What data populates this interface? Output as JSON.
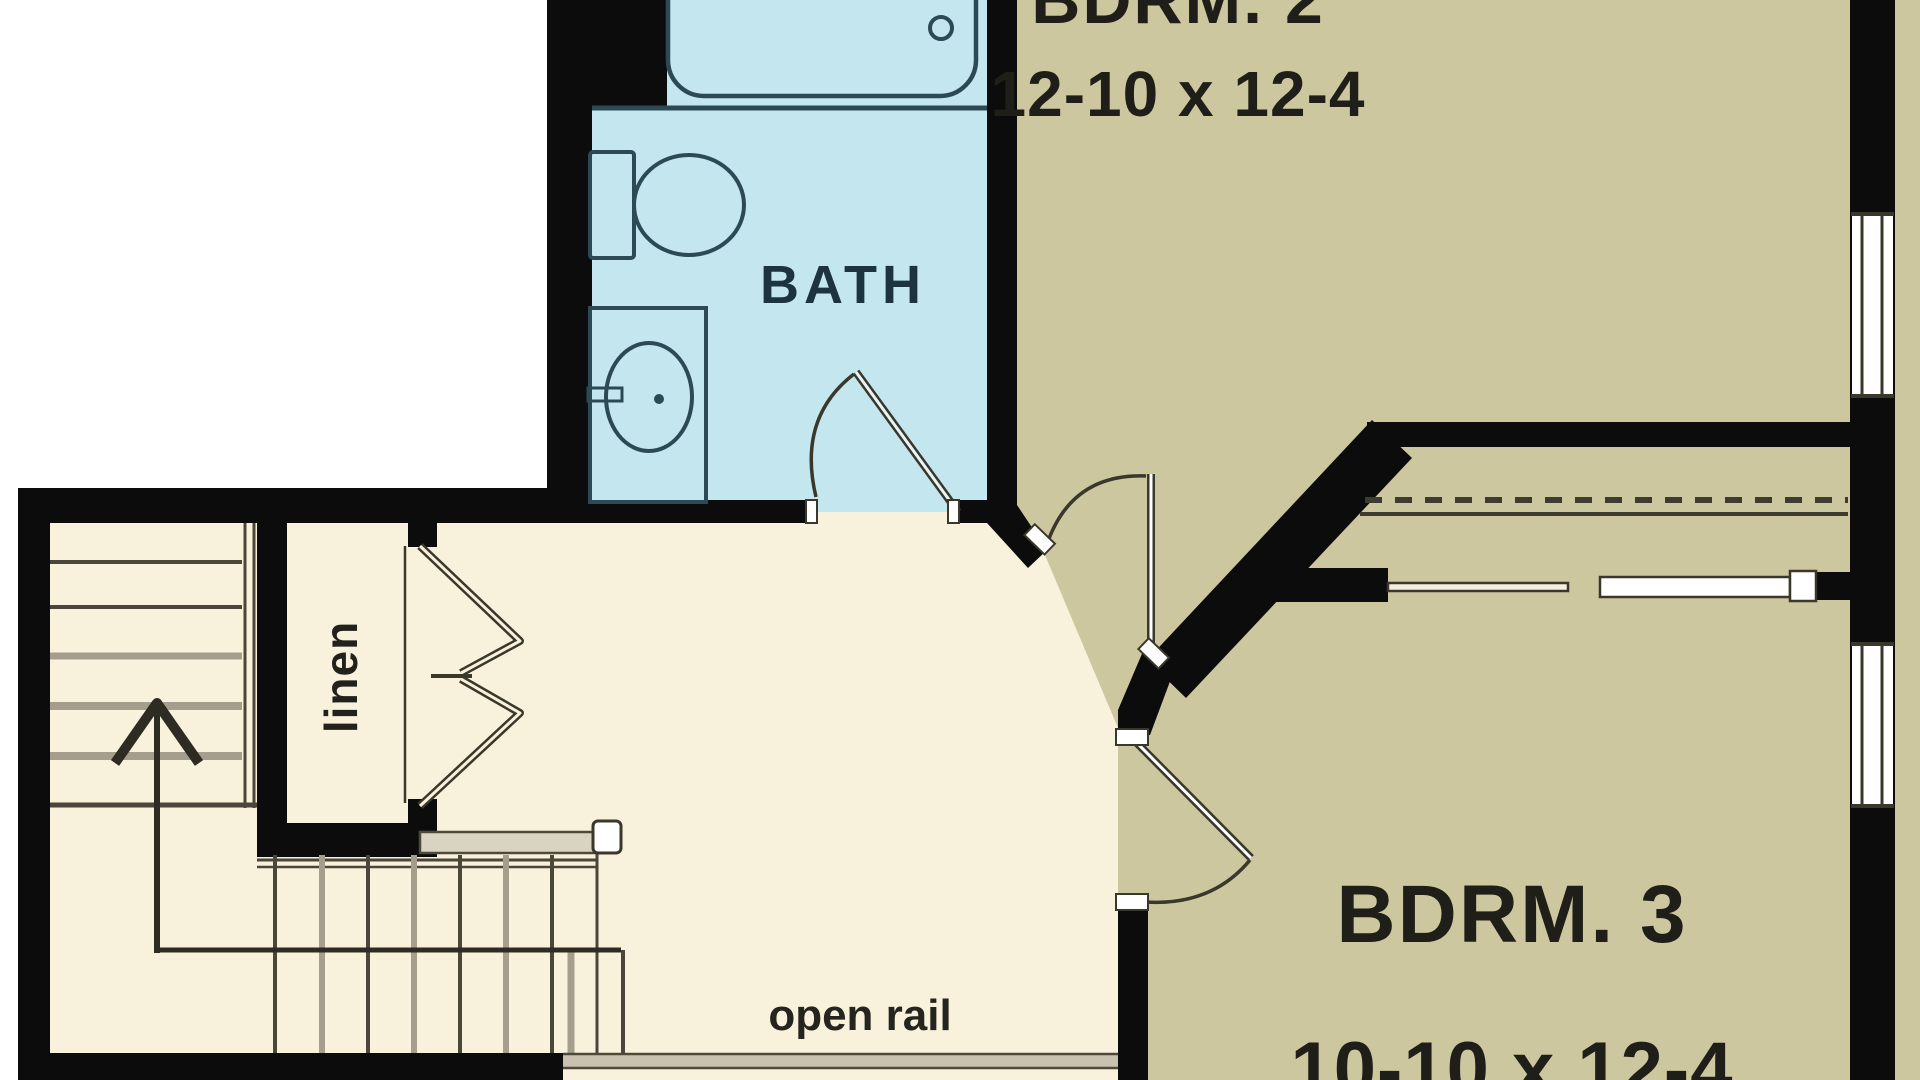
{
  "plan_type": "floor-plan",
  "rooms": {
    "bath": {
      "label": "BATH"
    },
    "bdrm2": {
      "label": "BDRM. 2",
      "dims": "12-10 x 12-4"
    },
    "bdrm3": {
      "label": "BDRM. 3",
      "dims": "10-10 x 12-4"
    },
    "linen": {
      "label": "linen"
    }
  },
  "annotations": {
    "open_rail": {
      "label": "open rail"
    },
    "stair_direction": "up"
  },
  "fixtures": [
    "bathtub",
    "toilet",
    "sink-vanity"
  ],
  "doors": [
    "bath-swing-door",
    "bdrm2-swing-door",
    "bdrm3-swing-door",
    "linen-bifold-door",
    "closet-bypass-door"
  ],
  "colors": {
    "background": "#ffffff",
    "wall": "#0c0c0c",
    "bath_floor": "#c4e6ef",
    "bedroom_floor": "#cdc7a0",
    "hall_floor": "#f8f1db",
    "plan_line": "#3a372b",
    "fixture_line": "#2c4a55",
    "tread_gray": "#a59e8d",
    "rail_gray": "#c9c2b1"
  }
}
